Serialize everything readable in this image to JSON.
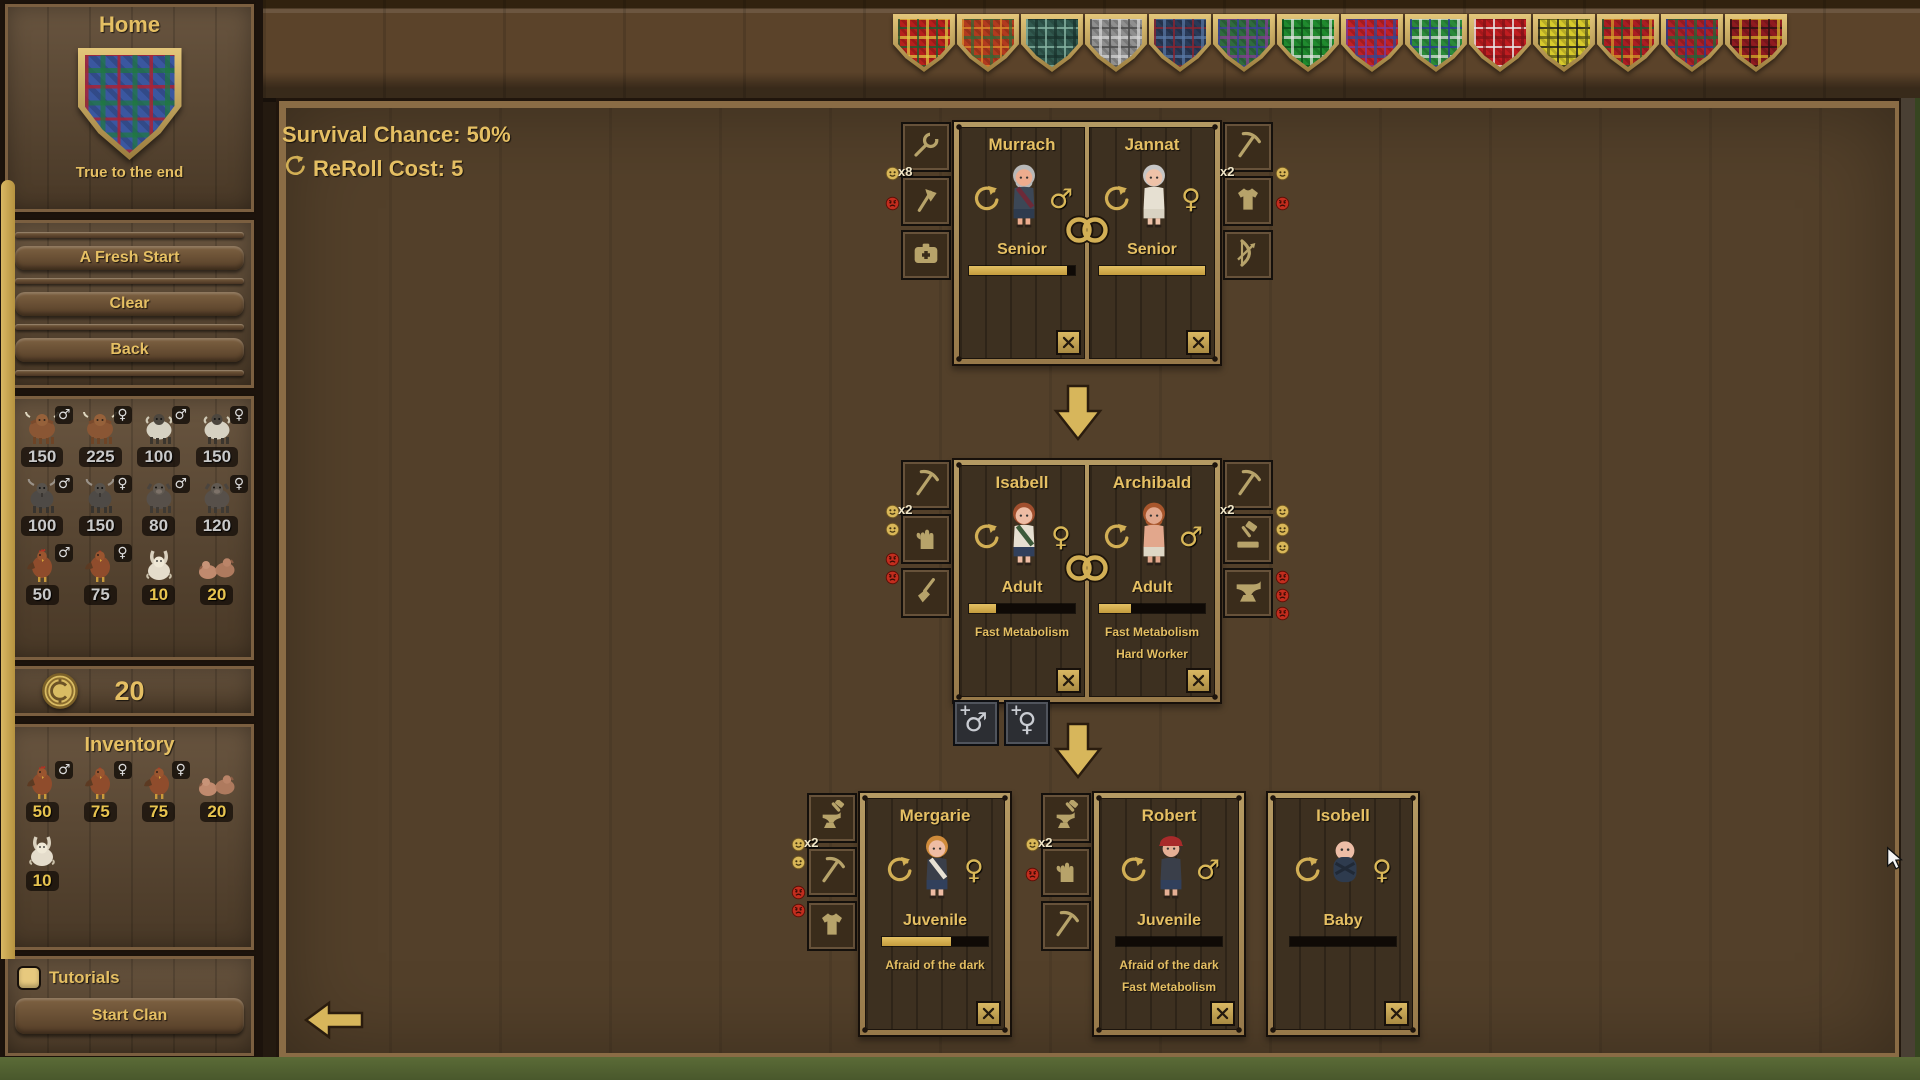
{
  "sidebar": {
    "home": {
      "title": "Home",
      "motto": "True to the end",
      "shield_tartan": {
        "base": "#3a57a0",
        "stripes": [
          "#b02030",
          "#1e7a3c"
        ]
      }
    },
    "menu_buttons": [
      {
        "label": "A Fresh Start"
      },
      {
        "label": "Clear"
      },
      {
        "label": "Back"
      }
    ],
    "livestock": [
      {
        "animal": "highland-cow",
        "gender": "male",
        "count": "150",
        "owned": false
      },
      {
        "animal": "highland-cow",
        "gender": "female",
        "count": "225",
        "owned": false
      },
      {
        "animal": "sheep",
        "gender": "male",
        "count": "100",
        "owned": false
      },
      {
        "animal": "sheep",
        "gender": "female",
        "count": "150",
        "owned": false
      },
      {
        "animal": "goat",
        "gender": "male",
        "count": "100",
        "owned": false
      },
      {
        "animal": "goat",
        "gender": "female",
        "count": "150",
        "owned": false
      },
      {
        "animal": "pig",
        "gender": "male",
        "count": "80",
        "owned": false
      },
      {
        "animal": "pig",
        "gender": "female",
        "count": "120",
        "owned": false
      },
      {
        "animal": "rooster",
        "gender": "male",
        "count": "50",
        "owned": false
      },
      {
        "animal": "hen",
        "gender": "female",
        "count": "75",
        "owned": false
      },
      {
        "animal": "rabbit",
        "gender": "",
        "count": "10",
        "owned": true
      },
      {
        "animal": "piglets",
        "gender": "",
        "count": "20",
        "owned": true
      }
    ],
    "currency": {
      "amount": "20"
    },
    "inventory": {
      "title": "Inventory",
      "items": [
        {
          "animal": "rooster",
          "gender": "male",
          "count": "50"
        },
        {
          "animal": "hen",
          "gender": "female",
          "count": "75"
        },
        {
          "animal": "hen",
          "gender": "female",
          "count": "75"
        },
        {
          "animal": "piglets",
          "gender": "",
          "count": "20"
        },
        {
          "animal": "rabbit",
          "gender": "",
          "count": "10"
        }
      ]
    },
    "tutorials": {
      "label": "Tutorials",
      "checked": true
    },
    "start_clan": {
      "label": "Start Clan"
    }
  },
  "top_bar": {
    "shields": [
      {
        "name": "red-green tartan",
        "base": "#b61f1c",
        "stripes": [
          "#1e5c30",
          "#e3cf43"
        ]
      },
      {
        "name": "red-orange tartan",
        "base": "#b23a1e",
        "stripes": [
          "#d98a2b",
          "#2e6b38"
        ]
      },
      {
        "name": "teal tartan",
        "base": "#31594f",
        "stripes": [
          "#86b3a2",
          "#17302a"
        ]
      },
      {
        "name": "grey tartan",
        "base": "#8f8f8f",
        "stripes": [
          "#494949",
          "#d9d9d9"
        ]
      },
      {
        "name": "navy tartan",
        "base": "#2a3a58",
        "stripes": [
          "#8a2430",
          "#5a7aa8"
        ]
      },
      {
        "name": "green-purple tartan",
        "base": "#2f6b3f",
        "stripes": [
          "#3a3f9a",
          "#8a3a9a"
        ]
      },
      {
        "name": "bright-green tartan",
        "base": "#1f8a2e",
        "stripes": [
          "#0a4a16",
          "#e8e8e8"
        ]
      },
      {
        "name": "red-purple tartan",
        "base": "#bf2026",
        "stripes": [
          "#7a3a9a",
          "#2a4a9a"
        ]
      },
      {
        "name": "green-blue tartan",
        "base": "#2a8a3a",
        "stripes": [
          "#2a3a9a",
          "#e8e8e8"
        ]
      },
      {
        "name": "red tartan",
        "base": "#bf1c20",
        "stripes": [
          "#e8e8e8",
          "#7a1216"
        ]
      },
      {
        "name": "yellow-black tartan",
        "base": "#d6c92c",
        "stripes": [
          "#1a1a1a",
          "#4a4a14"
        ]
      },
      {
        "name": "red-forest tartan",
        "base": "#ab1c22",
        "stripes": [
          "#1e5c34",
          "#d8a42a"
        ]
      },
      {
        "name": "red-blue tartan",
        "base": "#ab2028",
        "stripes": [
          "#2a3a8a",
          "#1a6a3a"
        ]
      },
      {
        "name": "dark-red tartan",
        "base": "#8e1a20",
        "stripes": [
          "#2a1012",
          "#d8b82a"
        ]
      }
    ]
  },
  "main": {
    "stats": {
      "survival_chance": "Survival Chance: 50%",
      "reroll_cost": "ReRoll Cost: 5"
    },
    "family_tree": {
      "generations": [
        {
          "kind": "couple",
          "left_panel": {
            "multiplier": "x8",
            "skills": [
              "wrench",
              "axe",
              "first-aid-kit"
            ],
            "happy": 1,
            "upset": 1
          },
          "right_panel": {
            "multiplier": "x2",
            "skills": [
              "pickaxe",
              "tunic",
              "bow"
            ],
            "happy": 1,
            "upset": 1
          },
          "members": [
            {
              "name": "Murrach",
              "stage": "Senior",
              "gender": "male",
              "age_progress": 0.92,
              "traits": [],
              "avatar": {
                "skin": "#edac8e",
                "hair": "#b8b8b8",
                "top": "#3c4756",
                "accent": "#6d2a38",
                "bottom": "#2e3b4e",
                "beard": true
              }
            },
            {
              "name": "Jannat",
              "stage": "Senior",
              "gender": "female",
              "age_progress": 1,
              "traits": [],
              "avatar": {
                "skin": "#eec2a8",
                "hair": "#c6c6c6",
                "top": "#e6e0d2",
                "accent": "",
                "bottom": "#d9d3c3"
              }
            }
          ]
        },
        {
          "kind": "couple",
          "left_panel": {
            "multiplier": "x2",
            "skills": [
              "pickaxe",
              "glove",
              "broom"
            ],
            "happy": 2,
            "upset": 2
          },
          "right_panel": {
            "multiplier": "x2",
            "skills": [
              "pickaxe",
              "mallet",
              "anvil"
            ],
            "happy": 3,
            "upset": 3
          },
          "members": [
            {
              "name": "Isabell",
              "stage": "Adult",
              "gender": "female",
              "age_progress": 0.25,
              "traits": [
                "Fast Metabolism"
              ],
              "avatar": {
                "skin": "#eebca4",
                "hair": "#a14f2e",
                "top": "#e6dfd1",
                "accent": "#3c5a3a",
                "bottom": "#31405c"
              }
            },
            {
              "name": "Archibald",
              "stage": "Adult",
              "gender": "male",
              "age_progress": 0.3,
              "traits": [
                "Fast Metabolism",
                "Hard Worker"
              ],
              "avatar": {
                "skin": "#e2a78c",
                "hair": "#a8562c",
                "top": "#e2a78c",
                "accent": "",
                "bottom": "#ded7c6",
                "beard": true
              }
            }
          ]
        },
        {
          "kind": "children",
          "cards": [
            {
              "panel": {
                "multiplier": "x2",
                "skills": [
                  "anvil-hammer",
                  "pickaxe",
                  "tunic"
                ],
                "happy": 2,
                "upset": 2
              },
              "member": {
                "name": "Mergarie",
                "stage": "Juvenile",
                "gender": "female",
                "age_progress": 0.65,
                "traits": [
                  "Afraid of the dark"
                ],
                "avatar": {
                  "skin": "#eebca4",
                  "hair": "#cf8b3a",
                  "top": "#3a3f4a",
                  "accent": "#e8e2d4",
                  "bottom": "#31405c"
                }
              }
            },
            {
              "panel": {
                "multiplier": "x2",
                "skills": [
                  "anvil-hammer",
                  "glove",
                  "pickaxe"
                ],
                "happy": 1,
                "upset": 1
              },
              "member": {
                "name": "Robert",
                "stage": "Juvenile",
                "gender": "male",
                "age_progress": 0,
                "traits": [
                  "Afraid of the dark",
                  "Fast Metabolism"
                ],
                "avatar": {
                  "skin": "#e6b095",
                  "hair": "#3a2e26",
                  "hat": "#a82a2a",
                  "top": "#3a3f4a",
                  "accent": "",
                  "bottom": "#31405c"
                }
              }
            },
            {
              "panel": null,
              "member": {
                "name": "Isobell",
                "stage": "Baby",
                "gender": "female",
                "age_progress": 0,
                "traits": [],
                "avatar": {
                  "skin": "#edbda6",
                  "top": "#2e3b4e",
                  "baby": true
                }
              }
            }
          ]
        }
      ],
      "add_child_buttons": [
        {
          "gender": "male",
          "plus": "+"
        },
        {
          "gender": "female",
          "plus": "+"
        }
      ]
    }
  },
  "colors": {
    "gold_text": "#e5bf63",
    "count_text": "#c9c9c9",
    "owned_count_text": "#e8c44f",
    "bar_fill": "#d8b254",
    "frame_tan": "#a88d58",
    "shield_gold": "#c9a952"
  }
}
